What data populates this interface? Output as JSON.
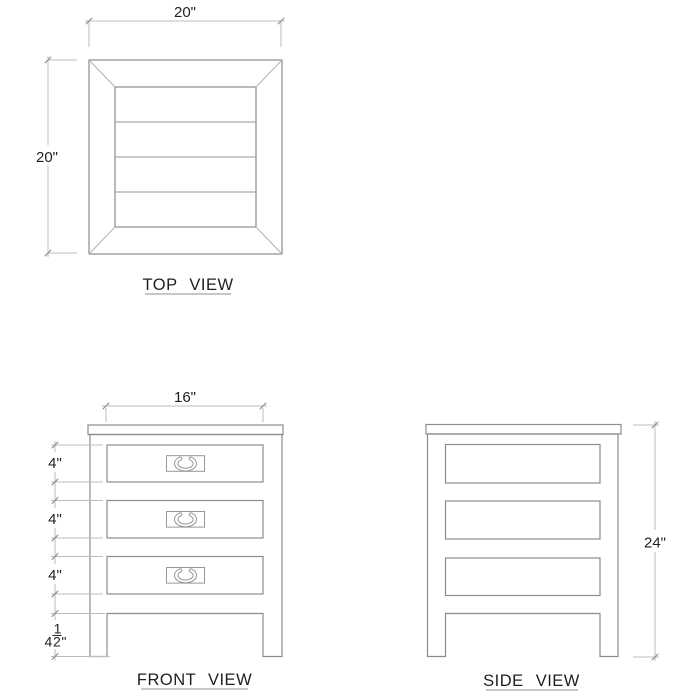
{
  "drawing": {
    "background": "#ffffff",
    "colors": {
      "object_line": "#8c8c8c",
      "dimension_line": "#bdbdbd",
      "tick_mark": "#8f8f8f",
      "text": "#1f1f1f"
    },
    "views": {
      "top": {
        "label": "TOP VIEW",
        "width_dim": "20\"",
        "depth_dim": "20\"",
        "slat_count": "4"
      },
      "front": {
        "label": "FRONT VIEW",
        "width_dim": "16\"",
        "drawer_dims": [
          "4\"",
          "4\"",
          "4\""
        ],
        "leg_dim": {
          "whole": "4",
          "numerator": "1",
          "denominator": "2",
          "unit": "\""
        }
      },
      "side": {
        "label": "SIDE VIEW",
        "height_dim": "24\""
      }
    }
  }
}
